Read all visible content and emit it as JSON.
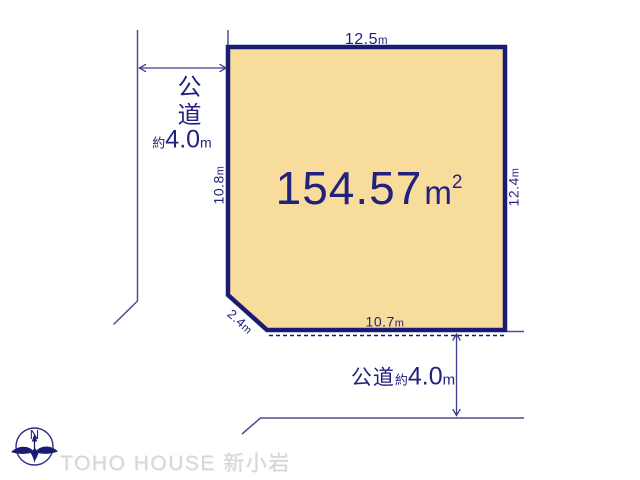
{
  "diagram": {
    "area": {
      "value": "154.57",
      "unit_base": "m",
      "unit_exp": "2"
    },
    "dims": {
      "top": {
        "value": "12.5",
        "unit": "m"
      },
      "left": {
        "value": "10.8",
        "unit": "m"
      },
      "right": {
        "value": "12.4",
        "unit": "m"
      },
      "bottom": {
        "value": "10.7",
        "unit": "m"
      },
      "corner": {
        "value": "2.4",
        "unit": "m"
      }
    },
    "road_left": {
      "name": "公道",
      "approx": "約",
      "width": "4.0",
      "unit": "m"
    },
    "road_bottom": {
      "name": "公道",
      "approx": "約",
      "width": "4.0",
      "unit": "m"
    }
  },
  "compass": {
    "north": "N"
  },
  "watermark": {
    "text": "TOHO HOUSE 新小岩"
  },
  "colors": {
    "plot_fill": "#f8dc9c",
    "plot_border_navy": "#1b1b73",
    "text_navy": "#22227e",
    "road_line_slate": "#4d4d8f",
    "watermark_gray": "#d6d6d6"
  }
}
